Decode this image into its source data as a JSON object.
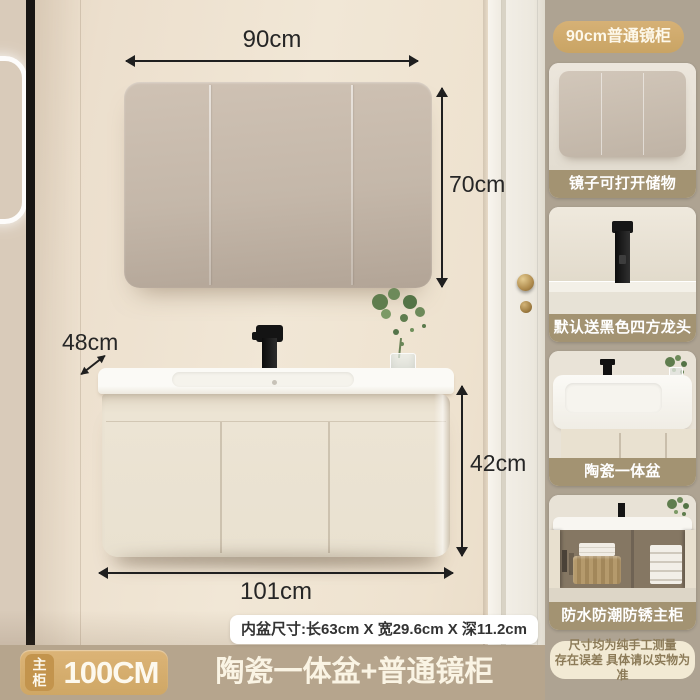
{
  "annotations": {
    "mirror_width": "90cm",
    "mirror_height": "70cm",
    "counter_depth": "48cm",
    "cabinet_height": "42cm",
    "cabinet_width": "101cm",
    "basin_note": "内盆尺寸:长63cm X 宽29.6cm X 深11.2cm"
  },
  "bottom_bar": {
    "badge_label": "主柜",
    "badge_size": "100CM",
    "title": "陶瓷一体盆+普通镜柜"
  },
  "sidebar": {
    "header_badge": "90cm普通镜柜",
    "cards": [
      {
        "caption": "镜子可打开储物"
      },
      {
        "caption": "默认送黑色四方龙头"
      },
      {
        "caption": "陶瓷一体盆"
      },
      {
        "caption": "防水防潮防锈主柜"
      }
    ],
    "disclaimer": {
      "line1": "尺寸均为纯手工测量",
      "line2": "存在误差 具体请以实物为准"
    }
  },
  "colors": {
    "accent_gold": "#d2ac6e",
    "bar_tan": "#b6a58d",
    "sidebar_bg": "#aea392",
    "caption_band": "#a39372",
    "wall_cream": "#f0e6d5",
    "mirror_greige": "#c4b7a9",
    "faucet_black": "#141414"
  }
}
